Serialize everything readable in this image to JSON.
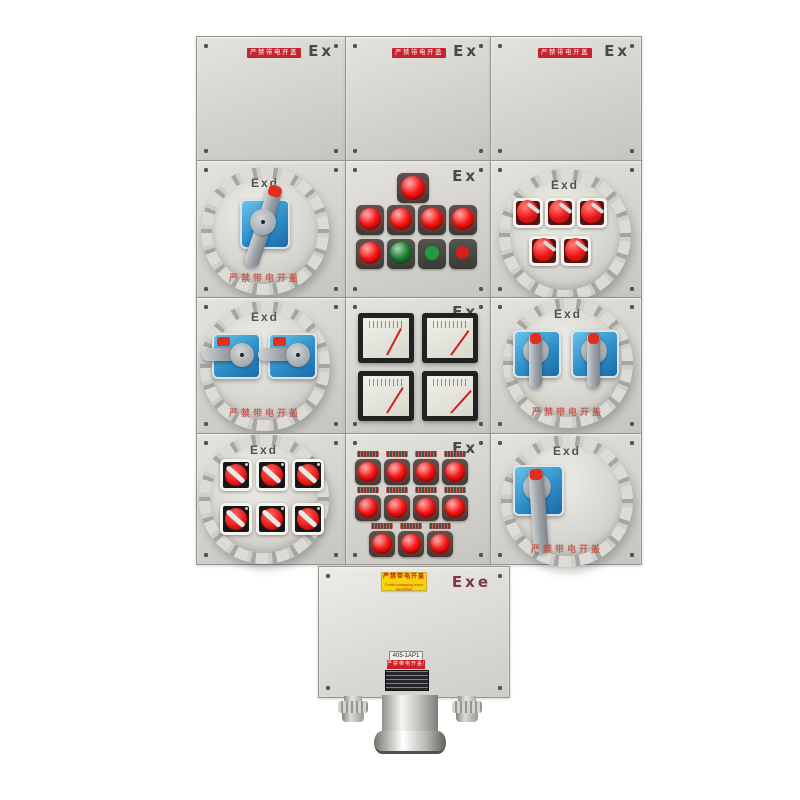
{
  "scene": {
    "subject": "Explosion-proof power distribution control box (product photo)"
  },
  "markings": {
    "ex": "Ex",
    "exd": "Exd",
    "exe": "Exe"
  },
  "warnings": {
    "red_plate_cn": "严禁带电开盖",
    "cover_paint_cn": "严禁带电开盖",
    "yellow_plate_cn": "严禁带电开盖",
    "yellow_plate_en": "Forbid uncapping when electrified",
    "red_strip_cn": "严禁带电开盖!"
  },
  "bottom_box": {
    "unit_label": "405-1AP1"
  },
  "inventory": {
    "blank_cover_panels": 3,
    "round_flameproof_covers": 6,
    "blue_rotary_switches": 6,
    "red_toggle_switches": 5,
    "red_rotary_switches": 6,
    "red_indicator_lamps": 17,
    "green_pushbuttons": 2,
    "red_pushbuttons": 1,
    "analog_meters": 4,
    "cable_glands": 3
  },
  "colors": {
    "enclosure": "#d3d2cc",
    "warning_red": "#c32430",
    "lamp_red": "#e81515",
    "switch_blue": "#2e8ec9",
    "label_yellow": "#f5d40a"
  }
}
